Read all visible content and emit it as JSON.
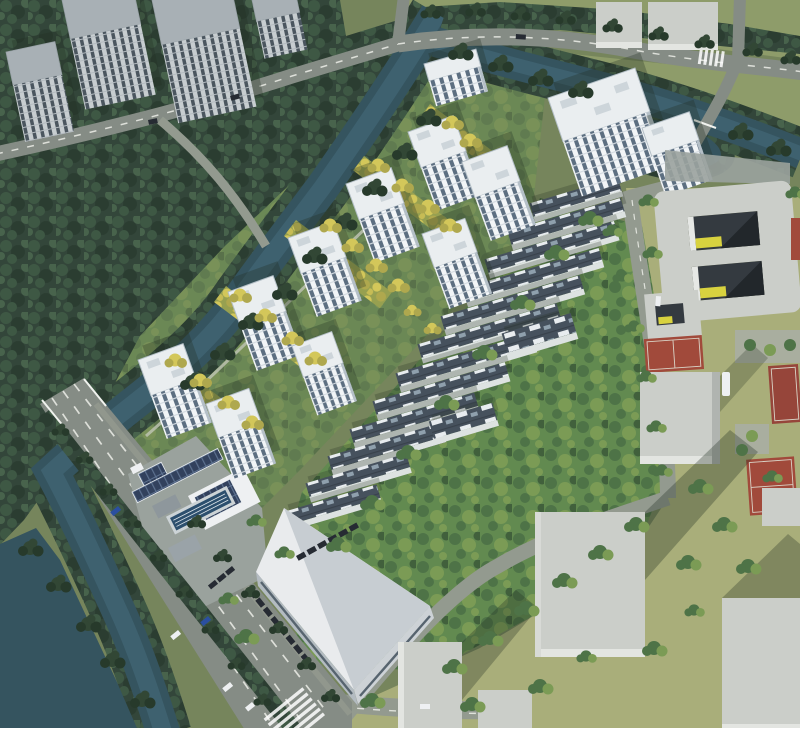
{
  "scene": {
    "description": "Aerial 3D rendering of a residential masterplan: white high-rise apartment towers and diagonal rows of townhouses with rooftop panels, set in greenery beside a tree-lined canal; a wide boulevard with lane markings and cars runs along the southwest, with a clubhouse, lap pool and solar canopy at the entrance, a large flat-roofed building with surface parking, and surrounding context: gray massing blocks, a courtyard building, basketball courts and dense tree masses",
    "features": [
      "context high-rise towers",
      "dense tree masses",
      "forked canal with tree-lined banks",
      "perimeter roads",
      "boulevard with dashed lane markings and crosswalk",
      "white residential towers",
      "golden tree-lined linear gardens",
      "townhouse rows with rooftop solar panels",
      "clubhouse with lap pool and solar canopy",
      "large flat-roof commercial building with parked cars",
      "double-courtyard building with yellow accents",
      "basketball courts",
      "gray context massing blocks casting shadows",
      "surface parking with trees",
      "cars on roads"
    ]
  },
  "colors": {
    "grassBase": "#76855c",
    "grassSun": "#a9ae7a",
    "grassNE": "#8e9c6a",
    "parkA": "#4e7347",
    "parkB": "#628a50",
    "parkC": "#7b9b55",
    "parkDk": "#41603c",
    "forestBase": "#33463a",
    "forestA": "#3e5844",
    "forestB": "#2b3d31",
    "forestC": "#48634c",
    "gold1": "#d3c75a",
    "gold2": "#afa84e",
    "gold3": "#c7bc55",
    "goldBg": "#97a050",
    "water": "#35545f",
    "waterL": "#4a7183",
    "road": "#858c85",
    "roadMinor": "#939a8f",
    "lane": "#f2f4ee",
    "towerFace": "#f2f5f7",
    "towerWin": "#5d6f81",
    "towerFloor": "#d4dbe1",
    "towerRoof": "#eaeef0",
    "towerEdge": "#b4bfc7",
    "towerBox": "#cdd5da",
    "ctxFace": "#c7cdd0",
    "ctxWin": "#4b565f",
    "ctxFloor": "#b4bbc0",
    "ctxRoof": "#a8b0b5",
    "thRoof": "#46515d",
    "thPanel": "#e8ecef",
    "thPanel2": "#8fa0ad",
    "thRidge": "#39424c",
    "thWall": "#dde2e1",
    "ctxGray": "#cbcec9",
    "ctxGrayL": "#e3e5e1",
    "shadow": "#223021",
    "courtRed": "#a14a3b",
    "courtRed2": "#96453a",
    "courtLine": "#d9d3c6",
    "pool": "#2c4f6e",
    "poolLane": "#dfe7ec",
    "solar": "#32415d",
    "solarL": "#5d718f",
    "carDark": "#262b33",
    "carBlue": "#2b4fa0",
    "carWhite": "#eef0f2",
    "carYellow": "#c9a62c",
    "bldgRoof": "#e9ebed",
    "bldgRoofShade": "#c7cdd2",
    "bldgWall": "#b3bbc1",
    "glaz": "#57646f",
    "plaza": "#9aa29d",
    "pathCol": "#bcc2b0",
    "rail": "#f0f2ee",
    "accentYellow": "#d8d23f",
    "treeDk1": "#324735",
    "treeDk2": "#273a2b"
  }
}
